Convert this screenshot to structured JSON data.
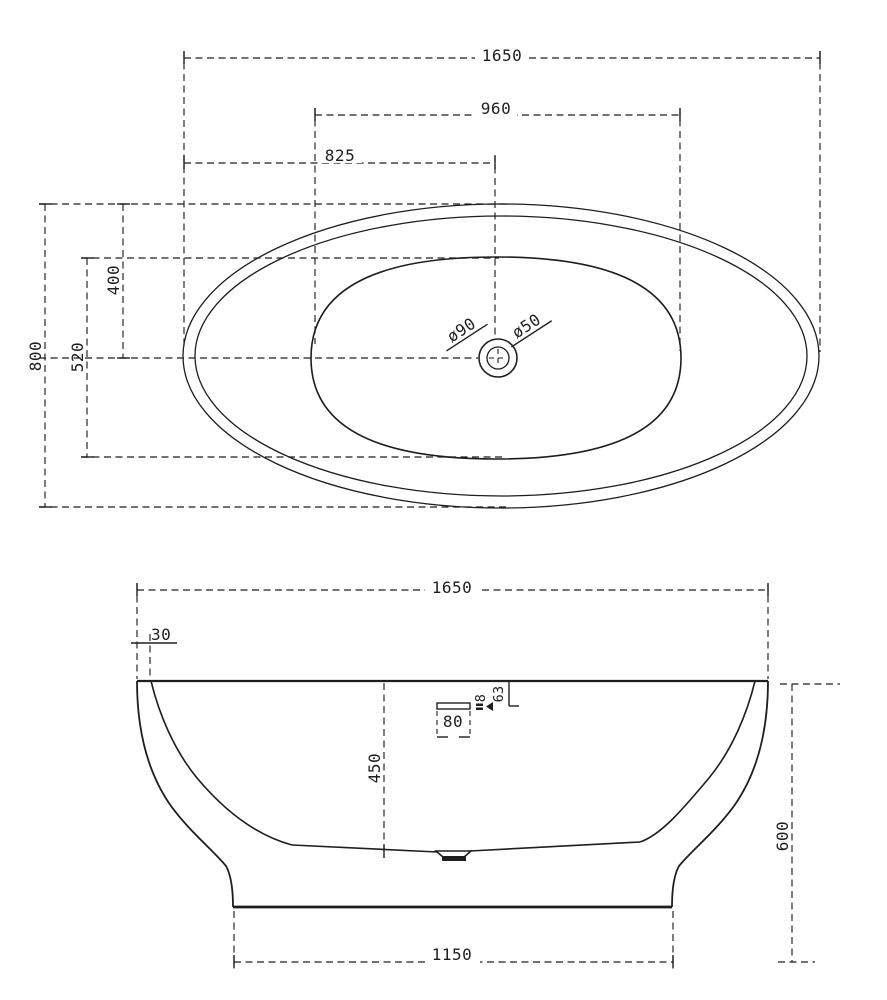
{
  "page": {
    "background": "#ffffff",
    "line_color": "#1e1e1e"
  },
  "top_view": {
    "length_overall": "1650",
    "length_inner": "960",
    "length_half": "825",
    "width_overall": "800",
    "width_inner": "520",
    "width_half": "400",
    "drain_outer_dia": "ø90",
    "drain_inner_dia": "ø50"
  },
  "side_view": {
    "length_overall": "1650",
    "rim_thickness": "30",
    "depth_inner": "450",
    "overflow_width": "80",
    "overflow_thickness": "8",
    "overflow_offset": "63",
    "height_overall": "600",
    "base_length": "1150"
  }
}
